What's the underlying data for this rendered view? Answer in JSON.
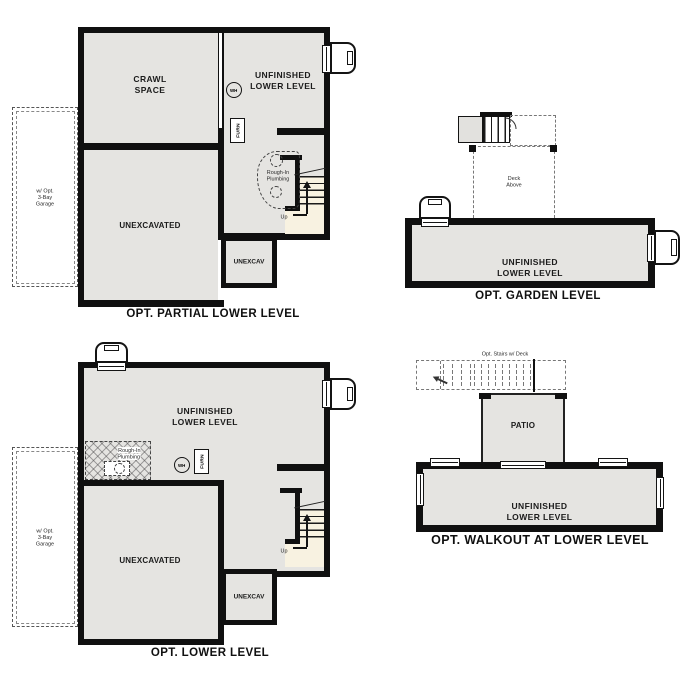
{
  "colors": {
    "wall": "#101010",
    "floor_fill": "#e5e4e1",
    "stair_fill": "#f8f2e1",
    "dashed_line": "#555555",
    "background": "#ffffff"
  },
  "plans": {
    "partial": {
      "title": "OPT. PARTIAL LOWER LEVEL",
      "garage_note": "w/ Opt.\n3-Bay\nGarage",
      "rooms": {
        "crawl_space": "CRAWL\nSPACE",
        "unfinished": "UNFINISHED\nLOWER LEVEL",
        "unexcavated": "UNEXCAVATED",
        "unexcav": "UNEXCAV"
      },
      "annotations": {
        "water_heater": "WH",
        "furnace": "FURN",
        "rough_in": "Rough-In\nPlumbing",
        "up": "Up"
      }
    },
    "garden": {
      "title": "OPT. GARDEN LEVEL",
      "rooms": {
        "unfinished": "UNFINISHED\nLOWER LEVEL"
      },
      "annotations": {
        "deck_above": "Deck\nAbove"
      }
    },
    "lower": {
      "title": "OPT. LOWER LEVEL",
      "garage_note": "w/ Opt.\n3-Bay\nGarage",
      "rooms": {
        "unfinished": "UNFINISHED\nLOWER LEVEL",
        "unexcavated": "UNEXCAVATED",
        "unexcav": "UNEXCAV"
      },
      "annotations": {
        "water_heater": "WH",
        "furnace": "FURN",
        "rough_in": "Rough-In\nPlumbing",
        "up": "Up"
      }
    },
    "walkout": {
      "title": "OPT. WALKOUT AT LOWER LEVEL",
      "rooms": {
        "patio": "PATIO",
        "unfinished": "UNFINISHED\nLOWER LEVEL"
      },
      "annotations": {
        "opt_stairs": "Opt. Stairs w/ Deck"
      }
    }
  }
}
